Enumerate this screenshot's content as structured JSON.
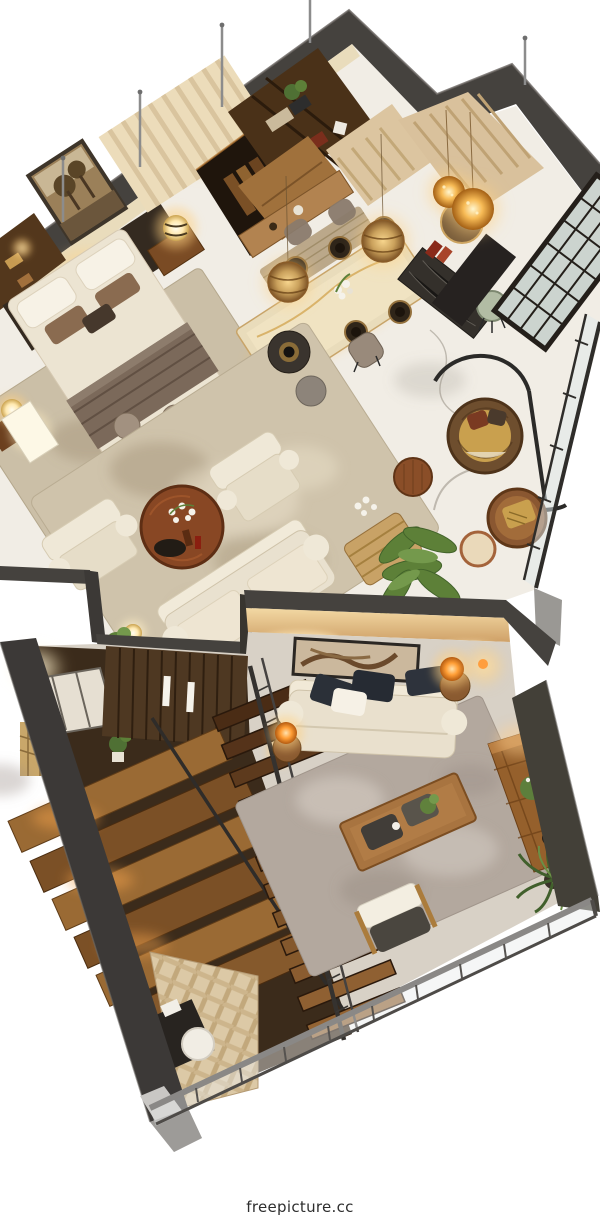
{
  "meta": {
    "type": "3D isometric cutaway floor-plan render",
    "levels": 2
  },
  "watermark": {
    "text": "freepicture.cc",
    "color": "#2e2e2e"
  },
  "palette": {
    "background": "#ffffff",
    "wall_top_charcoal": "#45423e",
    "wall_face_warm": "#e9d9b8",
    "marble_floor": "#f1ede5",
    "wood_dark": "#4e3822",
    "wood_mid": "#8a5a30",
    "wood_warm_lit": "#c8853a",
    "sofa_cream": "#eae2d0",
    "pillow_dark_navy": "#2b3038",
    "rug_upper_beige": "#cfc3ab",
    "rug_lower_gray": "#b3a89e",
    "lamp_glow_warm": "#ffd98f",
    "lamp_glow_orange": "#ff9a2e",
    "plant_green": "#5d8038",
    "glass": "#e6edf0",
    "railing_metal": "#55524f",
    "herringbone_wood": "#dcc9a6"
  },
  "scene": {
    "upper_floor": {
      "rooms": [
        {
          "name": "bedroom",
          "items": [
            "double-bed",
            "dark-headboard",
            "tree-artwork",
            "striped-wall-panel",
            "glowing-nightstand-lamps",
            "wardrobe-niche",
            "foot-bench",
            "two-stools",
            "area-rug"
          ]
        },
        {
          "name": "dining-kitchen",
          "items": [
            "bookshelf-unit",
            "wood-cabinet",
            "marble-dining-table",
            "six-place-settings",
            "taupe-dining-chairs",
            "wicker-pendant-lamps",
            "dark-bar-counter",
            "sage-stool"
          ]
        },
        {
          "name": "entry",
          "items": [
            "glowing-orb-pendants",
            "round-mirror",
            "dark-console",
            "beige-curtains",
            "black-grid-glazed-door"
          ]
        },
        {
          "name": "living-room",
          "items": [
            "cream-sofa",
            "cream-armchairs",
            "round-wood-coffee-table",
            "dark-side-table",
            "pouf",
            "glowing-floor-lamp",
            "patterned-rug"
          ]
        },
        {
          "name": "balcony",
          "items": [
            "hanging-rattan-chair",
            "rattan-round-table",
            "wicker-bench",
            "wood-stool",
            "banana-plant",
            "glass-railing"
          ]
        }
      ]
    },
    "lower_floor": {
      "rooms": [
        {
          "name": "stairwell",
          "items": [
            "wood-panel-wall",
            "wide-landing-steps",
            "main-staircase",
            "metal-handrails",
            "window",
            "floor-glow-lamp",
            "patterned-curtain"
          ]
        },
        {
          "name": "family-room",
          "items": [
            "cream-sofa",
            "black-cushions",
            "long-wall-art",
            "orange-glow-table-lamps",
            "wood-coffee-table",
            "two-trays",
            "wood-armchair",
            "sideboard",
            "flower-plant",
            "corner-fern",
            "gray-rug"
          ]
        },
        {
          "name": "terrace-edge",
          "items": [
            "metal-glass-railing",
            "herringbone-parquet",
            "dark-side-table",
            "white-round-seat"
          ]
        }
      ]
    }
  }
}
